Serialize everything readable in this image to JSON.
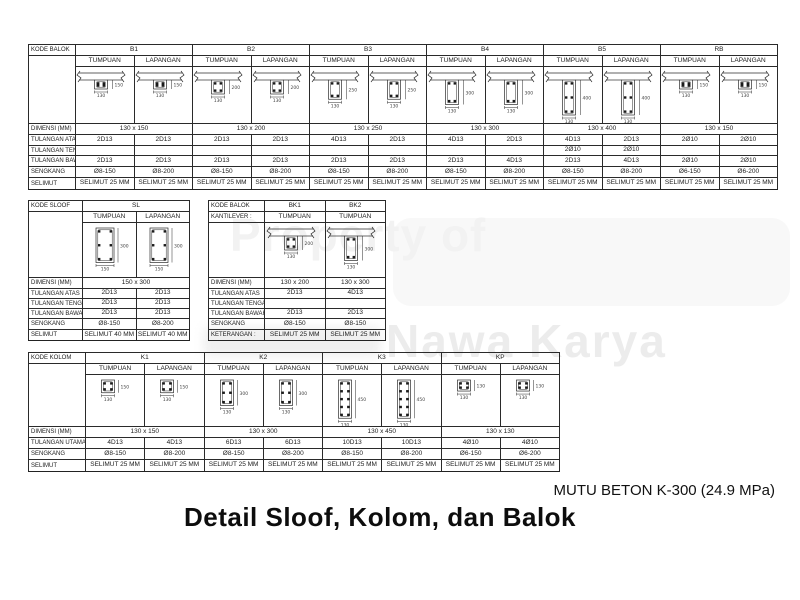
{
  "watermark": {
    "line1": "Property of",
    "line2": "Nawa Karya"
  },
  "footer": {
    "mutu": "MUTU BETON K-300 (24.9 MPa)",
    "title": "Detail Sloof, Kolom, dan Balok"
  },
  "tables": {
    "balok": {
      "code_label": "KODE BALOK",
      "dimensi_label": "DIMENSI (MM)",
      "row_labels": [
        "TULANGAN ATAS",
        "TULANGAN TENGAH",
        "TULANGAN BAWAH",
        "SENGKANG",
        "SELIMUT"
      ],
      "groups": [
        {
          "code": "B1",
          "dimensi": "130 x 150",
          "cols": [
            {
              "sub": "TUMPUAN",
              "diagram": {
                "type": "tee",
                "w": 130,
                "h": 150
              },
              "values": [
                "2D13",
                "",
                "2D13",
                "Ø8-150",
                "SELIMUT 25 MM"
              ]
            },
            {
              "sub": "LAPANGAN",
              "diagram": {
                "type": "tee",
                "w": 130,
                "h": 150
              },
              "values": [
                "2D13",
                "",
                "2D13",
                "Ø8-200",
                "SELIMUT 25 MM"
              ]
            }
          ]
        },
        {
          "code": "B2",
          "dimensi": "130 x 200",
          "cols": [
            {
              "sub": "TUMPUAN",
              "diagram": {
                "type": "tee",
                "w": 130,
                "h": 200
              },
              "values": [
                "2D13",
                "",
                "2D13",
                "Ø8-150",
                "SELIMUT 25 MM"
              ]
            },
            {
              "sub": "LAPANGAN",
              "diagram": {
                "type": "tee",
                "w": 130,
                "h": 200
              },
              "values": [
                "2D13",
                "",
                "2D13",
                "Ø8-200",
                "SELIMUT 25 MM"
              ]
            }
          ]
        },
        {
          "code": "B3",
          "dimensi": "130 x 250",
          "cols": [
            {
              "sub": "TUMPUAN",
              "diagram": {
                "type": "tee",
                "w": 130,
                "h": 250
              },
              "values": [
                "4D13",
                "",
                "2D13",
                "Ø8-150",
                "SELIMUT 25 MM"
              ]
            },
            {
              "sub": "LAPANGAN",
              "diagram": {
                "type": "tee",
                "w": 130,
                "h": 250
              },
              "values": [
                "2D13",
                "",
                "2D13",
                "Ø8-200",
                "SELIMUT 25 MM"
              ]
            }
          ]
        },
        {
          "code": "B4",
          "dimensi": "130 x 300",
          "cols": [
            {
              "sub": "TUMPUAN",
              "diagram": {
                "type": "tee",
                "w": 130,
                "h": 300
              },
              "values": [
                "4D13",
                "",
                "2D13",
                "Ø8-150",
                "SELIMUT 25 MM"
              ]
            },
            {
              "sub": "LAPANGAN",
              "diagram": {
                "type": "tee",
                "w": 130,
                "h": 300
              },
              "values": [
                "2D13",
                "",
                "4D13",
                "Ø8-200",
                "SELIMUT 25 MM"
              ]
            }
          ]
        },
        {
          "code": "B5",
          "dimensi": "130 x 400",
          "cols": [
            {
              "sub": "TUMPUAN",
              "diagram": {
                "type": "tee",
                "w": 130,
                "h": 400,
                "mid": true
              },
              "values": [
                "4D13",
                "2Ø10",
                "2D13",
                "Ø8-150",
                "SELIMUT 25 MM"
              ]
            },
            {
              "sub": "LAPANGAN",
              "diagram": {
                "type": "tee",
                "w": 130,
                "h": 400,
                "mid": true
              },
              "values": [
                "2D13",
                "2Ø10",
                "4D13",
                "Ø8-200",
                "SELIMUT 25 MM"
              ]
            }
          ]
        },
        {
          "code": "RB",
          "dimensi": "130 x 150",
          "cols": [
            {
              "sub": "TUMPUAN",
              "diagram": {
                "type": "tee",
                "w": 130,
                "h": 150
              },
              "values": [
                "2Ø10",
                "",
                "2Ø10",
                "Ø6-150",
                "SELIMUT 25 MM"
              ]
            },
            {
              "sub": "LAPANGAN",
              "diagram": {
                "type": "tee",
                "w": 130,
                "h": 150
              },
              "values": [
                "2Ø10",
                "",
                "2Ø10",
                "Ø6-200",
                "SELIMUT 25 MM"
              ]
            }
          ]
        }
      ]
    },
    "sloof": {
      "code_label": "KODE SLOOF",
      "dimensi_label": "DIMENSI (MM)",
      "row_labels": [
        "TULANGAN ATAS",
        "TULANGAN TENGAH",
        "TULANGAN BAWAH",
        "SENGKANG",
        "SELIMUT"
      ],
      "groups": [
        {
          "code": "SL",
          "dimensi": "150 x 300",
          "cols": [
            {
              "sub": "TUMPUAN",
              "diagram": {
                "type": "rect",
                "w": 150,
                "h": 300,
                "bars": 6
              },
              "values": [
                "2D13",
                "2D13",
                "2D13",
                "Ø8-150",
                "SELIMUT 40 MM"
              ]
            },
            {
              "sub": "LAPANGAN",
              "diagram": {
                "type": "rect",
                "w": 150,
                "h": 300,
                "bars": 6
              },
              "values": [
                "2D13",
                "2D13",
                "2D13",
                "Ø8-200",
                "SELIMUT 40 MM"
              ]
            }
          ]
        }
      ]
    },
    "kantilever": {
      "code_label": "KODE BALOK",
      "code_label2": "KANTILEVER :",
      "dimensi_label": "DIMENSI (MM)",
      "row_labels": [
        "TULANGAN ATAS",
        "TULANGAN TENGAH",
        "TULANGAN BAWAH",
        "SENGKANG",
        "KETERANGAN :"
      ],
      "groups": [
        {
          "code": "BK1",
          "dimensi": "130 x 200",
          "cols": [
            {
              "sub": "TUMPUAN",
              "diagram": {
                "type": "tee",
                "w": 130,
                "h": 200
              },
              "values": [
                "2D13",
                "",
                "2D13",
                "Ø8-150",
                "SELIMUT 25 MM"
              ]
            }
          ]
        },
        {
          "code": "BK2",
          "dimensi": "130 x 300",
          "cols": [
            {
              "sub": "TUMPUAN",
              "diagram": {
                "type": "tee",
                "w": 130,
                "h": 300
              },
              "values": [
                "4D13",
                "",
                "2D13",
                "Ø8-150",
                "SELIMUT 25 MM"
              ]
            }
          ]
        }
      ]
    },
    "kolom": {
      "code_label": "KODE KOLOM",
      "dimensi_label": "DIMENSI (MM)",
      "row_labels": [
        "TULANGAN UTAMA",
        "SENGKANG",
        "SELIMUT"
      ],
      "groups": [
        {
          "code": "K1",
          "dimensi": "130 x 150",
          "cols": [
            {
              "sub": "TUMPUAN",
              "diagram": {
                "type": "col",
                "w": 130,
                "h": 150,
                "bars": 4
              },
              "values": [
                "4D13",
                "Ø8-150",
                "SELIMUT 25 MM"
              ]
            },
            {
              "sub": "LAPANGAN",
              "diagram": {
                "type": "col",
                "w": 130,
                "h": 150,
                "bars": 4
              },
              "values": [
                "4D13",
                "Ø8-200",
                "SELIMUT 25 MM"
              ]
            }
          ]
        },
        {
          "code": "K2",
          "dimensi": "130 x 300",
          "cols": [
            {
              "sub": "TUMPUAN",
              "diagram": {
                "type": "col",
                "w": 130,
                "h": 300,
                "bars": 6
              },
              "values": [
                "6D13",
                "Ø8-150",
                "SELIMUT 25 MM"
              ]
            },
            {
              "sub": "LAPANGAN",
              "diagram": {
                "type": "col",
                "w": 130,
                "h": 300,
                "bars": 6
              },
              "values": [
                "6D13",
                "Ø8-200",
                "SELIMUT 25 MM"
              ]
            }
          ]
        },
        {
          "code": "K3",
          "dimensi": "130 x 450",
          "cols": [
            {
              "sub": "TUMPUAN",
              "diagram": {
                "type": "col",
                "w": 130,
                "h": 450,
                "bars": 10
              },
              "values": [
                "10D13",
                "Ø8-150",
                "SELIMUT 25 MM"
              ]
            },
            {
              "sub": "LAPANGAN",
              "diagram": {
                "type": "col",
                "w": 130,
                "h": 450,
                "bars": 10
              },
              "values": [
                "10D13",
                "Ø8-200",
                "SELIMUT 25 MM"
              ]
            }
          ]
        },
        {
          "code": "KP",
          "dimensi": "130 x 130",
          "cols": [
            {
              "sub": "TUMPUAN",
              "diagram": {
                "type": "col",
                "w": 130,
                "h": 130,
                "bars": 4
              },
              "values": [
                "4Ø10",
                "Ø6-150",
                "SELIMUT 25 MM"
              ]
            },
            {
              "sub": "LAPANGAN",
              "diagram": {
                "type": "col",
                "w": 130,
                "h": 130,
                "bars": 4
              },
              "values": [
                "4Ø10",
                "Ø6-200",
                "SELIMUT 25 MM"
              ]
            }
          ]
        }
      ]
    }
  }
}
